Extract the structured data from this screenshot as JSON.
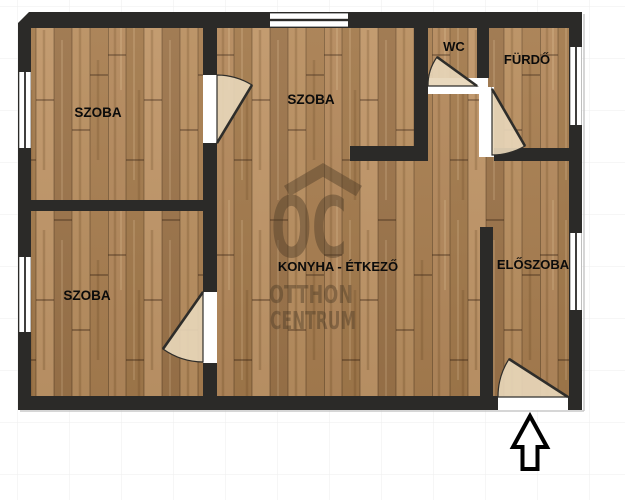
{
  "plan": {
    "rooms": [
      {
        "key": "szoba_top_left",
        "label": "SZOBA"
      },
      {
        "key": "szoba_top_middle",
        "label": "SZOBA"
      },
      {
        "key": "wc",
        "label": "WC"
      },
      {
        "key": "furdo",
        "label": "FÜRDŐ"
      },
      {
        "key": "szoba_bottom_left",
        "label": "SZOBA"
      },
      {
        "key": "konyha_etkezo",
        "label": "KONYHA - ÉTKEZŐ"
      },
      {
        "key": "eloszoba",
        "label": "ELŐSZOBA"
      }
    ],
    "watermark": {
      "logo": "OC",
      "name_line1": "OTTHON",
      "name_line2": "CENTRUM"
    },
    "colors": {
      "wall": "#2b2a28",
      "floor": "#b08656",
      "door_fan": "#e7d6b9",
      "watermark": "#4b3a26"
    },
    "icons": {
      "entrance": "up-arrow"
    }
  }
}
